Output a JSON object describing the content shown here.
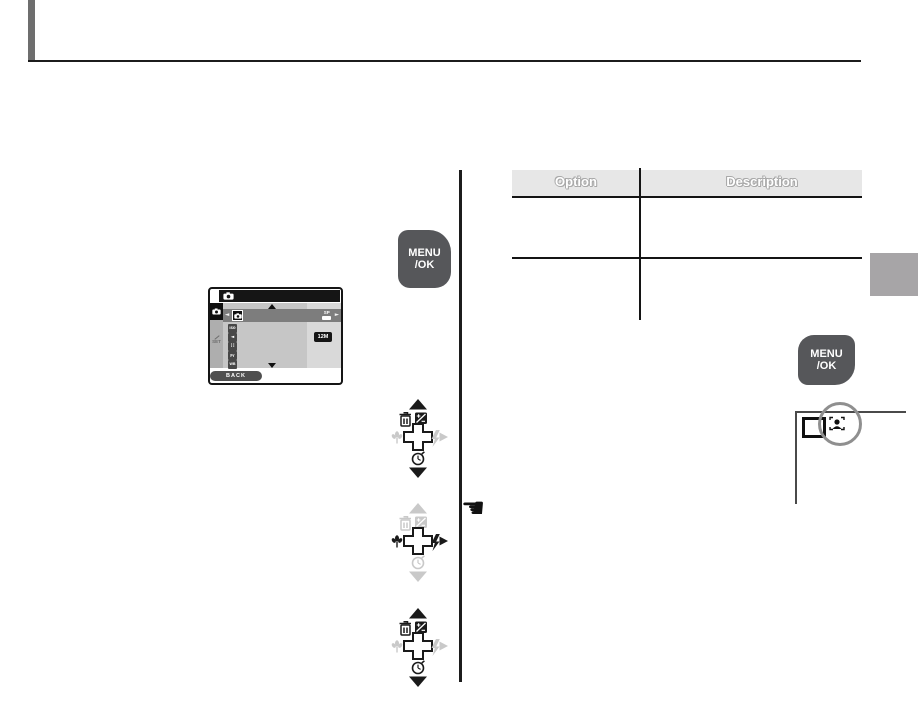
{
  "header": {
    "edge_bar_color": "#6e6e6e",
    "rule_color": "#1c1c1c"
  },
  "menu_ok_button": {
    "line1": "MENU",
    "line2": "/OK",
    "color": "#56575a"
  },
  "menu_screen": {
    "scroll_up_glyph": "▲",
    "scroll_down_glyph": "▼",
    "selected_row": {
      "cursor_left": "◄",
      "cursor_right": "►",
      "icon": "camera-icon",
      "value_label": "SP"
    },
    "items": [
      {
        "icon": "iso-icon",
        "label": "ISO"
      },
      {
        "icon": "sound-icon",
        "label": "◄"
      },
      {
        "icon": "image-quality-icon",
        "label": "∷"
      },
      {
        "icon": "finepix-color-icon",
        "label": "Fr"
      },
      {
        "icon": "white-balance-icon",
        "label": "WB"
      }
    ],
    "resolution_badge": "12M",
    "back_label": "BACK",
    "setup_tab_label": "SET"
  },
  "selector_pads": [
    {
      "active": [
        "up",
        "down",
        "delete",
        "exposure-compensation",
        "self-timer"
      ],
      "inactive": [
        "macro",
        "flash",
        "right"
      ]
    },
    {
      "active": [
        "flash",
        "right"
      ],
      "inactive": [
        "up",
        "down",
        "delete",
        "exposure-compensation",
        "self-timer",
        "macro"
      ]
    },
    {
      "active": [
        "up",
        "down",
        "delete",
        "exposure-compensation",
        "self-timer"
      ],
      "inactive": [
        "macro",
        "flash",
        "right"
      ]
    }
  ],
  "pointer": {
    "glyph": "☚"
  },
  "table": {
    "header_bg": "#e7e7e7",
    "headers": [
      "Option",
      "Description"
    ],
    "rows": [
      {
        "option": "",
        "description": ""
      },
      {
        "option": "",
        "description": ""
      }
    ]
  },
  "lcd_detail": {
    "icons": [
      "frame-brackets-icon",
      "face-detection-icon"
    ],
    "annotation_circle_color": "#8f8f8f"
  },
  "side_tab": {
    "color": "#a7a5a7"
  }
}
